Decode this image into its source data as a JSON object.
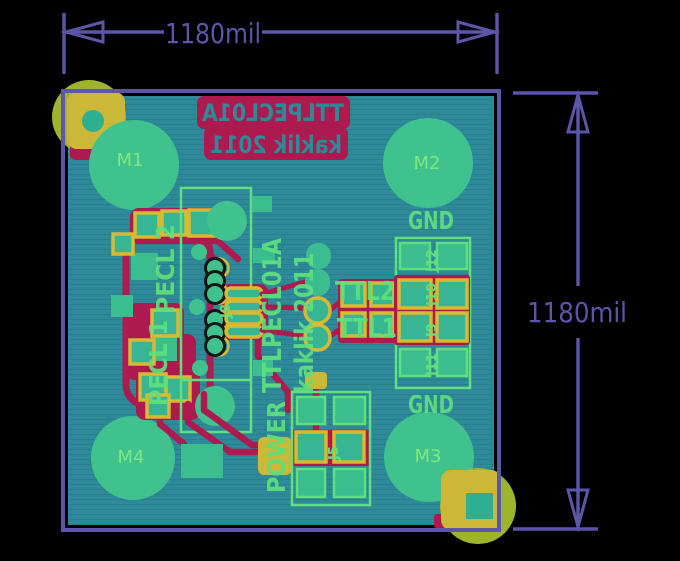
{
  "annotations": {
    "top_dimension": "1180mil",
    "right_dimension": "1180mil"
  },
  "board": {
    "silk_block": {
      "line1": "TTLPECL01A",
      "line2": "kaklik 2011",
      "mirrored": true
    },
    "mounting_holes": {
      "m1": "M1",
      "m2": "M2",
      "m3": "M3",
      "m4": "M4"
    },
    "ground_labels": {
      "top": "GND",
      "bottom": "GND"
    },
    "vertical_labels": {
      "part_title": "TTLPECL01A",
      "author_year": "kaklik 2011",
      "power": "POWER",
      "pecl2": "PECL 2",
      "pecl1": "PECL 1"
    },
    "signal_labels": {
      "ttl2": "TTL2",
      "ttl1": "TTL1"
    },
    "connector_labels": {
      "j12": "J12",
      "j10": "J10",
      "j9": "J9",
      "j11": "J11",
      "j8": "J8",
      "j5": "J5"
    }
  },
  "colors": {
    "background": "#000000",
    "board_copper": "#2e8a98",
    "board_copper_dark": "#27808e",
    "silk_green": "#5fe07c",
    "silk_red": "#ac1a4f",
    "pad_yellow": "#d8ba32",
    "pad_fill": "#38b694",
    "corner_gold": "#ccb838",
    "corner_olive": "#9fb42d",
    "hole_green": "#40c28e",
    "m_label_green": "#7ee87d",
    "dimension_purple": "#5c56a9",
    "teal_pad": "#3cbd90"
  }
}
